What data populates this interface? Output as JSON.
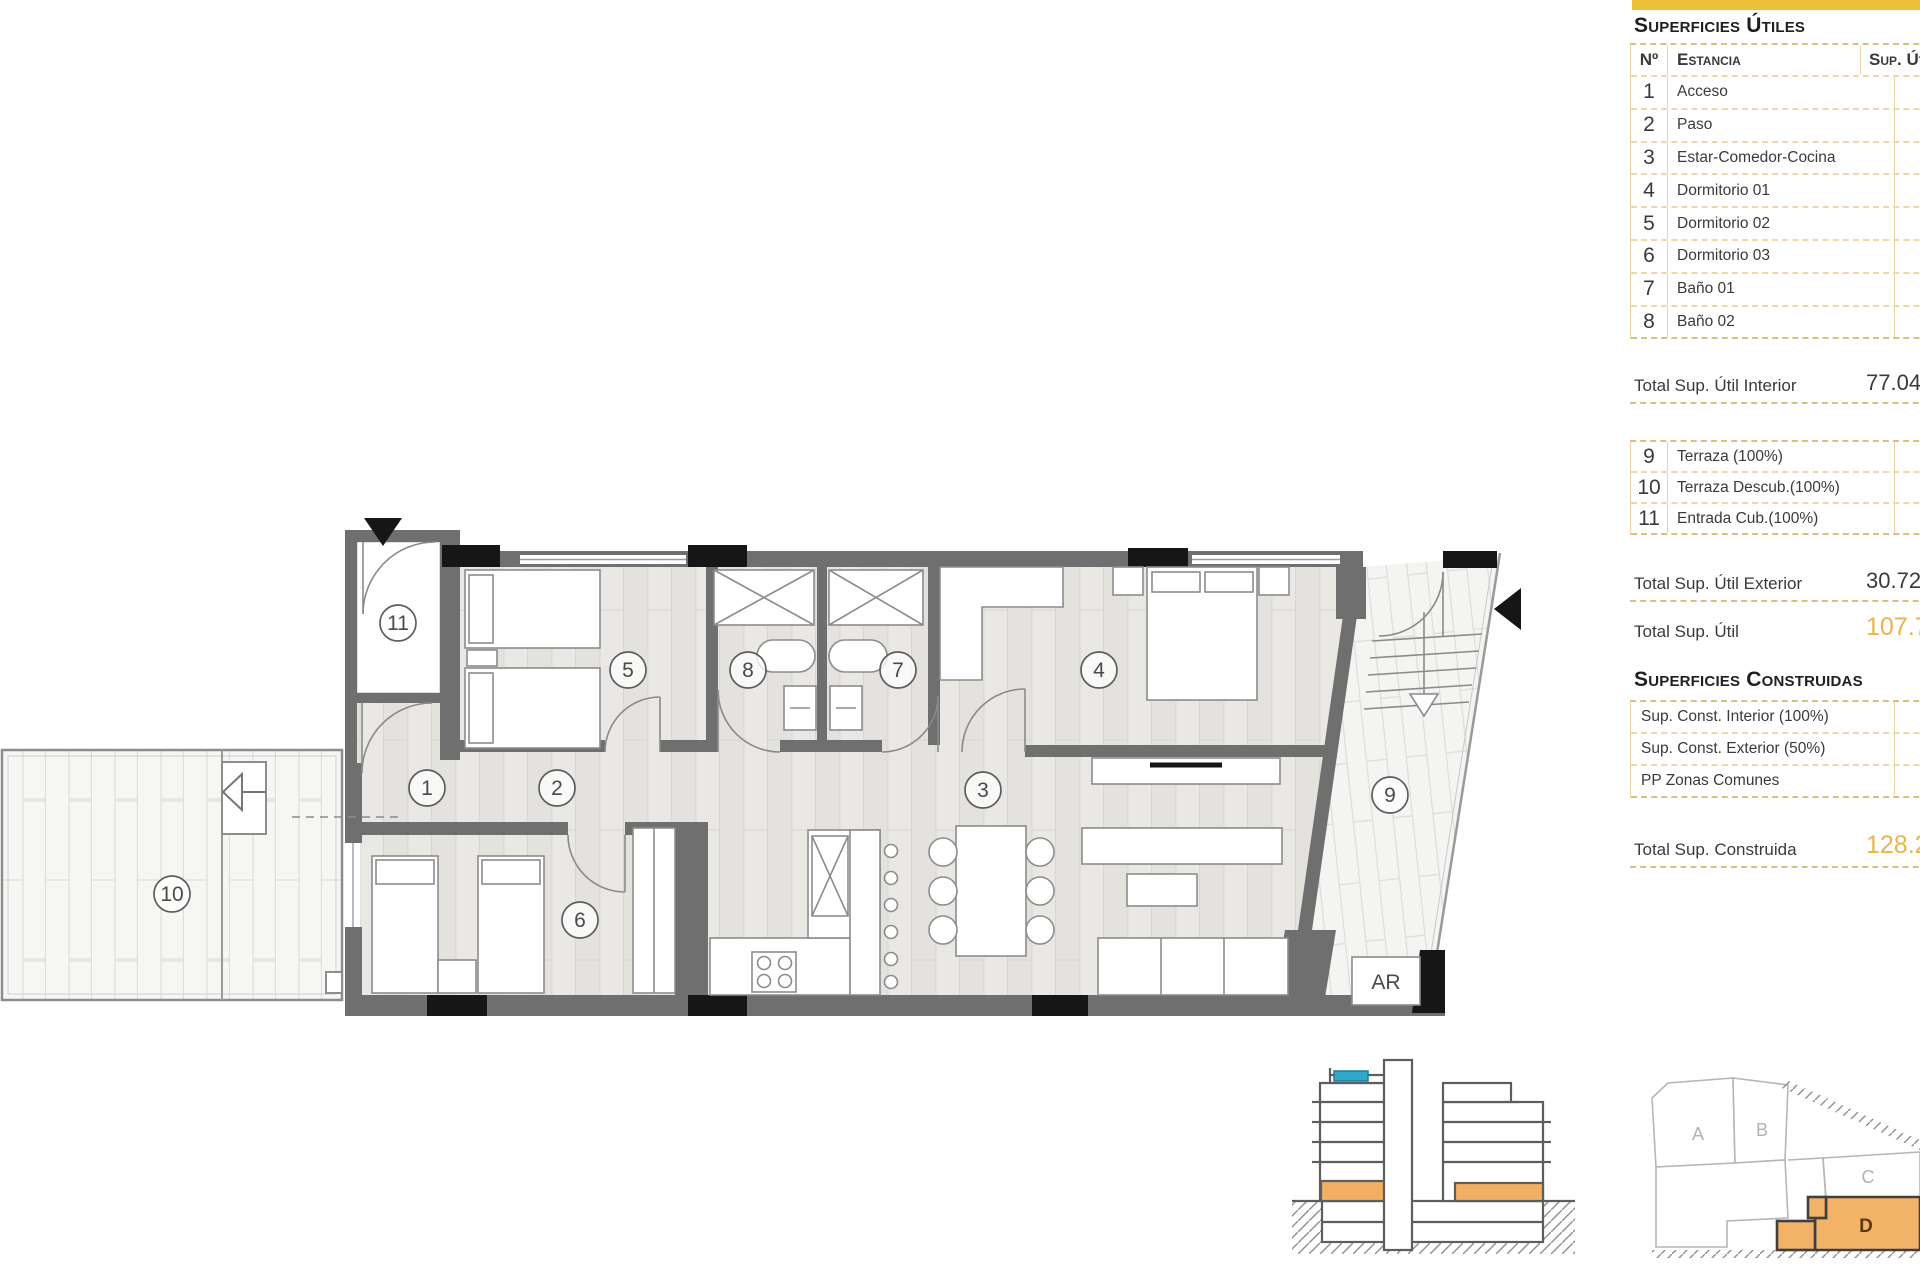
{
  "accent": {
    "bar_yellow": "#EFBF37",
    "table_dash": "#E4C283",
    "total_orange": "#E9B44B",
    "plan_wall_gray": "#6F6F6F",
    "highlight_orange": "#F2AF64",
    "section_blue": "#2FA7C9"
  },
  "tables": {
    "utiles": {
      "title": "Superficies Útiles",
      "headers": {
        "num": "Nº",
        "room": "Estancia",
        "sup": "Sup. Útil"
      },
      "rows": [
        {
          "n": "1",
          "name": "Acceso",
          "value": "1.94"
        },
        {
          "n": "2",
          "name": "Paso",
          "value": "3.67"
        },
        {
          "n": "3",
          "name": "Estar-Comedor-Cocina",
          "value": "29.39"
        },
        {
          "n": "4",
          "name": "Dormitorio 01",
          "value": "15.03"
        },
        {
          "n": "5",
          "name": "Dormitorio 02",
          "value": "9.29"
        },
        {
          "n": "6",
          "name": "Dormitorio 03",
          "value": "10.30"
        },
        {
          "n": "7",
          "name": "Baño 01",
          "value": "3.71"
        },
        {
          "n": "8",
          "name": "Baño 02",
          "value": "3.71"
        }
      ],
      "total_interior": {
        "label": "Total Sup. Útil Interior",
        "value": "77.04"
      },
      "rows_ext": [
        {
          "n": "9",
          "name": "Terraza (100%)",
          "value": "11.88"
        },
        {
          "n": "10",
          "name": "Terraza Descub.(100%)",
          "value": "16.08"
        },
        {
          "n": "11",
          "name": "Entrada Cub.(100%)",
          "value": "2.76"
        }
      ],
      "total_exterior": {
        "label": "Total Sup. Útil Exterior",
        "value": "30.72"
      },
      "total": {
        "label": "Total Sup. Útil",
        "value": "107.76"
      }
    },
    "construidas": {
      "title": "Superficies Construidas",
      "rows": [
        {
          "name": "Sup. Const. Interior (100%)",
          "value": "90.48"
        },
        {
          "name": "Sup. Const. Exterior (50%)",
          "value": "23.68"
        },
        {
          "name": "PP Zonas Comunes",
          "value": "14.05"
        }
      ],
      "total": {
        "label": "Total Sup. Construida",
        "value": "128.21"
      }
    }
  },
  "plan": {
    "room_numbers": [
      "1",
      "2",
      "3",
      "4",
      "5",
      "6",
      "7",
      "8",
      "9",
      "10",
      "11"
    ],
    "storage_label": "AR"
  },
  "site": {
    "blocks": [
      "A",
      "B",
      "C",
      "D"
    ]
  }
}
